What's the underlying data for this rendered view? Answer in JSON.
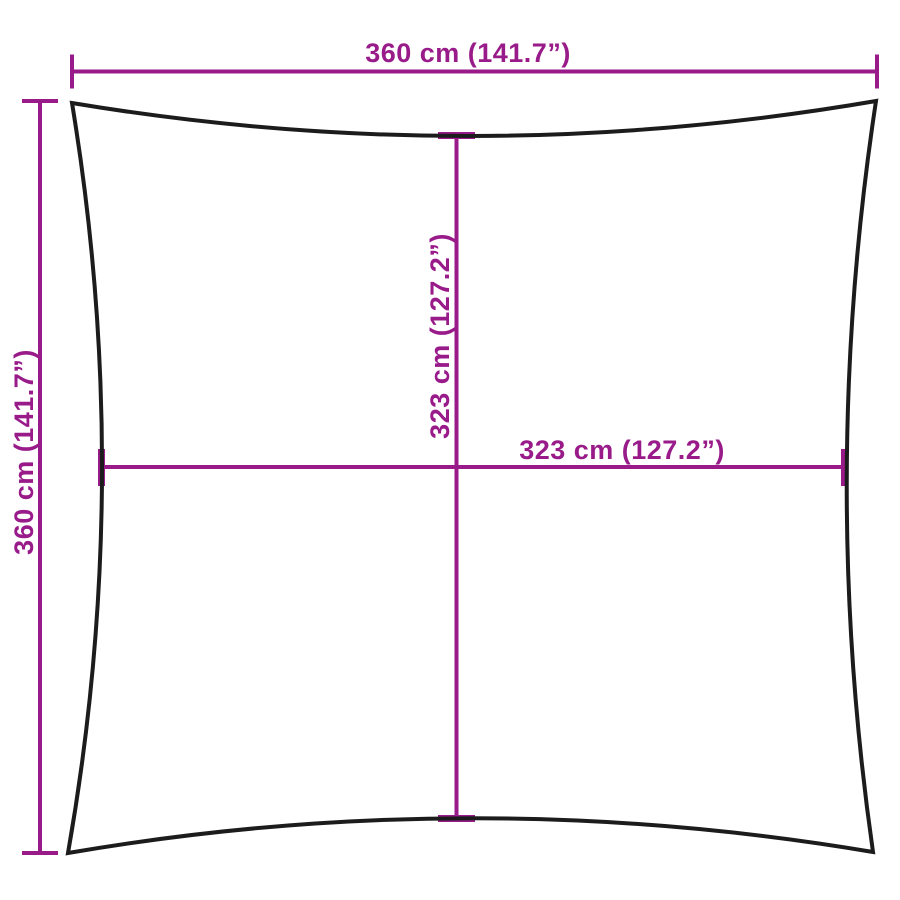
{
  "diagram": {
    "type": "product-dimension-diagram",
    "subject": "square shade sail with concave edges",
    "background_color": "#ffffff",
    "outline_color": "#1c1c1c",
    "dimension_color": "#981b89",
    "labels": {
      "overall_width": "360 cm (141.7”)",
      "overall_height": "360 cm (141.7”)",
      "inner_width": "323 cm (127.2”)",
      "inner_height": "323 cm (127.2”)"
    },
    "values": {
      "overall_width_cm": 360,
      "overall_width_in": 141.7,
      "overall_height_cm": 360,
      "overall_height_in": 141.7,
      "inner_width_cm": 323,
      "inner_width_in": 127.2,
      "inner_height_cm": 323,
      "inner_height_in": 127.2
    }
  }
}
